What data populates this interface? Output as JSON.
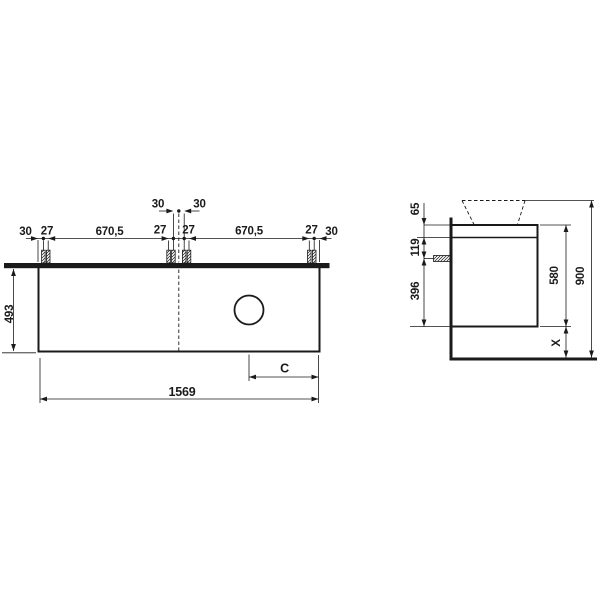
{
  "drawing": {
    "front": {
      "center_pair": [
        "30",
        "30"
      ],
      "chain": [
        "30",
        "27",
        "670,5",
        "27",
        "27",
        "670,5",
        "27",
        "30"
      ],
      "height": "493",
      "total_width": "1569",
      "c_label": "C"
    },
    "side": {
      "top_offset": "65",
      "upper_section": "119",
      "lower_section": "396",
      "cabinet_height": "580",
      "floor_gap": "X",
      "total_height": "900"
    }
  }
}
